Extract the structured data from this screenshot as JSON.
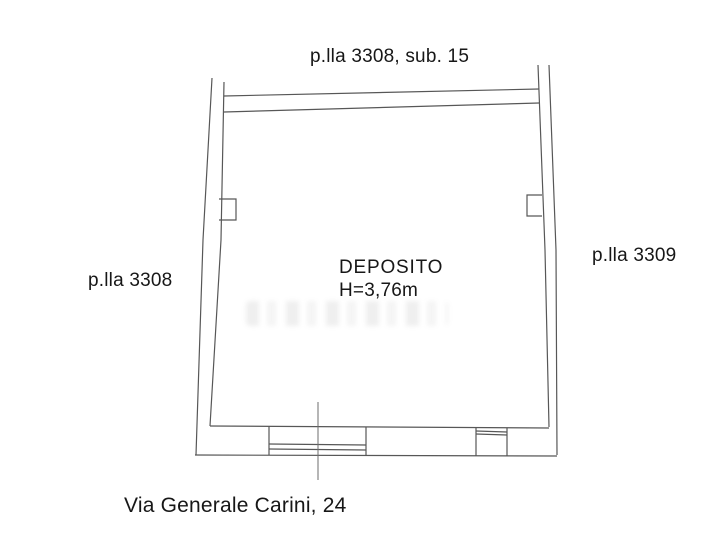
{
  "colors": {
    "background": "#ffffff",
    "wall_line": "#575757",
    "text": "#171717",
    "watermark": "#999999"
  },
  "labels": {
    "parcel_top": "p.lla 3308, sub. 15",
    "parcel_left": "p.lla 3308",
    "parcel_right": "p.lla 3309",
    "room_name": "DEPOSITO",
    "room_height": "H=3,76m",
    "street_address": "Via Generale Carini, 24"
  },
  "plan": {
    "room_name": "DEPOSITO",
    "room_height_label": "H=3,76m",
    "adjacent_parcels": [
      "p.lla 3308, sub. 15",
      "p.lla 3308",
      "p.lla 3309"
    ],
    "street": "Via Generale Carini, 24"
  }
}
